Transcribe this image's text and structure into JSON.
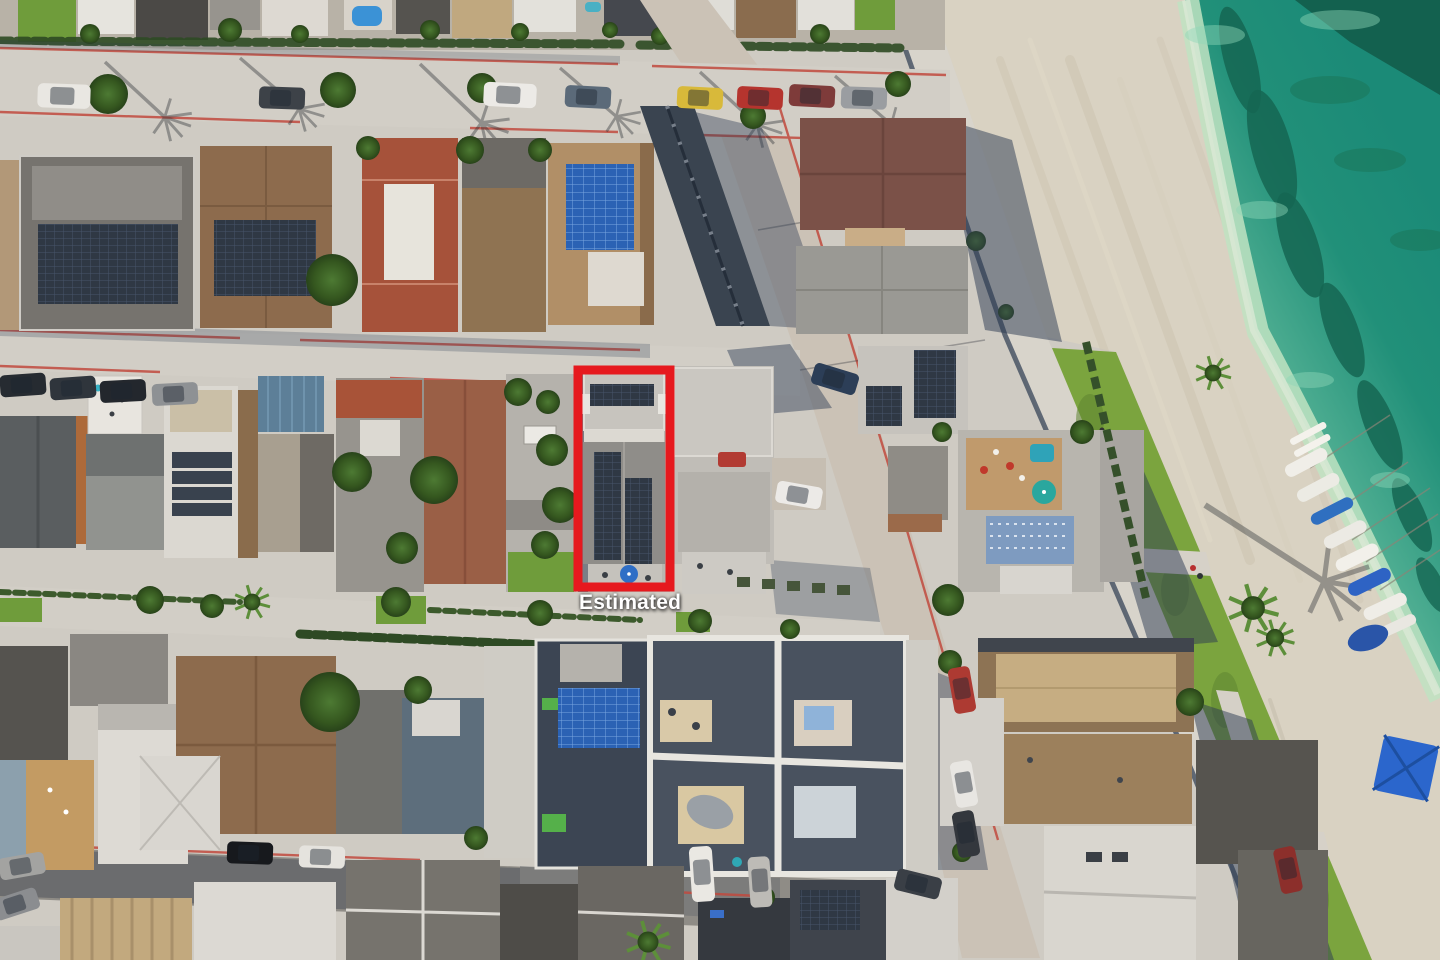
{
  "annotation": {
    "label": "Estimated"
  },
  "overlay": {
    "boundary_color": "#e6191e",
    "label_color": "#ffffff"
  },
  "palette": {
    "water": "#1f907b",
    "water_shallow": "#bfe3c2",
    "seaweed": "#156652",
    "sand": "#d9d2c2",
    "grass": "#7ba43e",
    "boardwalk": "#d8d4cb",
    "concrete": "#d2cec6",
    "road": "#cbc2b6",
    "red_curb": "#c14a3e",
    "shadow": "#2b3a52",
    "lawn": "#6f9c3b",
    "roof_gray": "#8f8d89",
    "roof_brown": "#8d6b4d",
    "roof_red_tile": "#a6523a",
    "solar_dark": "#2f3844",
    "solar_blue": "#2b62b4",
    "tree": "#35571f",
    "umbrella_blue": "#2e6ec6",
    "umbrella_red": "#c75d65"
  }
}
